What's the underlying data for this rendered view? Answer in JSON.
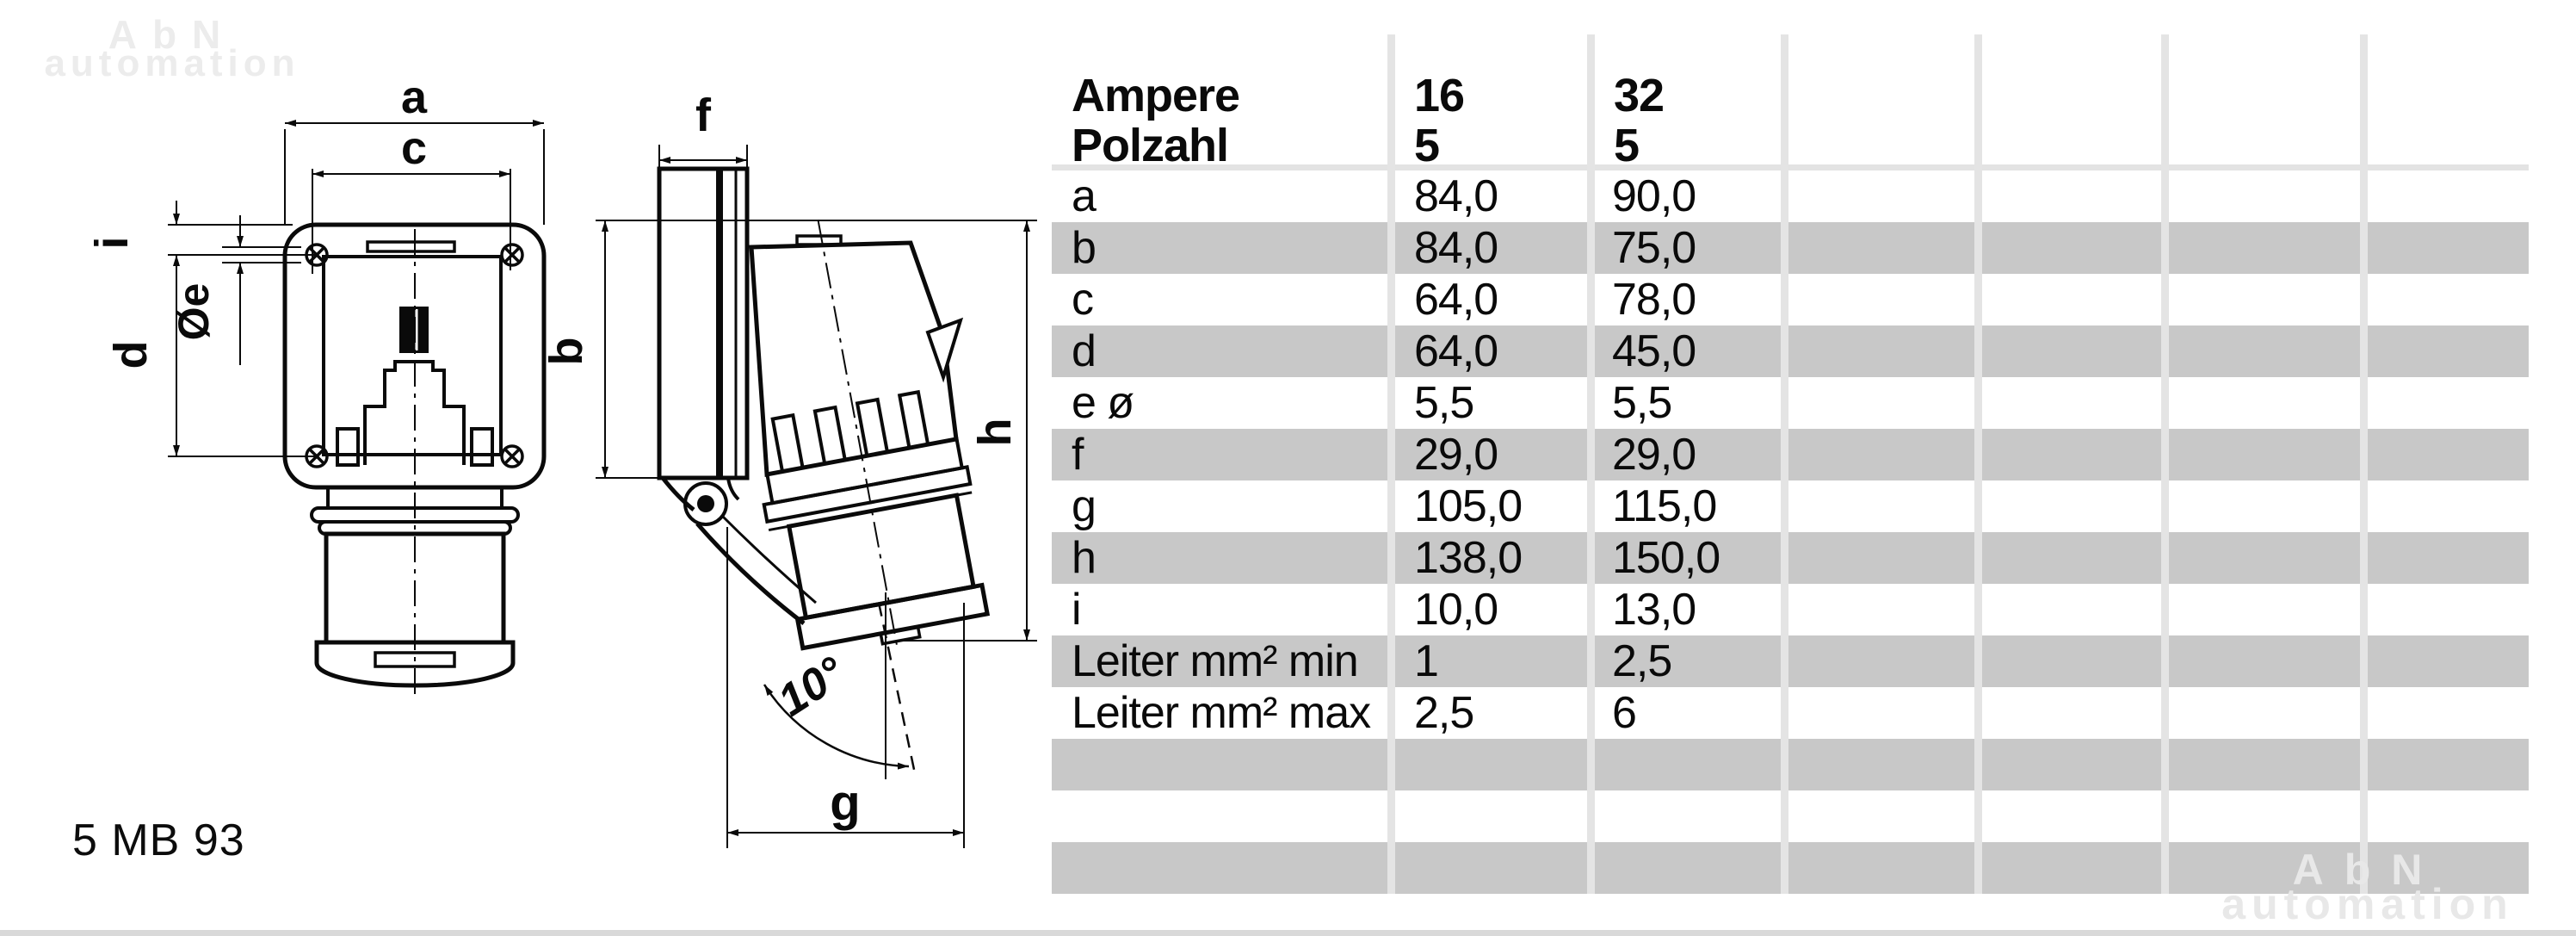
{
  "watermark": {
    "line1": "AbN",
    "line2": "automation"
  },
  "part_number": "5 MB 93",
  "drawing": {
    "labels": {
      "a": "a",
      "c": "c",
      "i": "i",
      "diameter_e": "Øe",
      "d": "d",
      "b": "b",
      "f": "f",
      "h": "h",
      "g": "g",
      "angle": "10°"
    }
  },
  "table": {
    "header_rows": [
      {
        "label": "Ampere",
        "col16": "16",
        "col32": "32"
      },
      {
        "label": "Polzahl",
        "col16": "5",
        "col32": "5"
      }
    ],
    "rows": [
      {
        "label": "a",
        "col16": "84,0",
        "col32": "90,0"
      },
      {
        "label": "b",
        "col16": "84,0",
        "col32": "75,0"
      },
      {
        "label": "c",
        "col16": "64,0",
        "col32": "78,0"
      },
      {
        "label": "d",
        "col16": "64,0",
        "col32": "45,0"
      },
      {
        "label": "e ø",
        "col16": "5,5",
        "col32": "5,5"
      },
      {
        "label": "f",
        "col16": "29,0",
        "col32": "29,0"
      },
      {
        "label": "g",
        "col16": "105,0",
        "col32": "115,0"
      },
      {
        "label": "h",
        "col16": "138,0",
        "col32": "150,0"
      },
      {
        "label": "i",
        "col16": "10,0",
        "col32": "13,0"
      },
      {
        "label": "Leiter mm² min",
        "col16": "1",
        "col32": "2,5"
      },
      {
        "label": "Leiter mm² max",
        "col16": "2,5",
        "col32": "6"
      },
      {
        "label": "",
        "col16": "",
        "col32": ""
      },
      {
        "label": "",
        "col16": "",
        "col32": ""
      },
      {
        "label": "",
        "col16": "",
        "col32": ""
      }
    ]
  },
  "colors": {
    "stripe": "#c8c8c8",
    "column_line": "#e4e4e4",
    "header_rule": "#e3e3e3",
    "bottom_rule": "#d9d9d9",
    "watermark": "#ececec",
    "ink": "#0a0a0a"
  }
}
